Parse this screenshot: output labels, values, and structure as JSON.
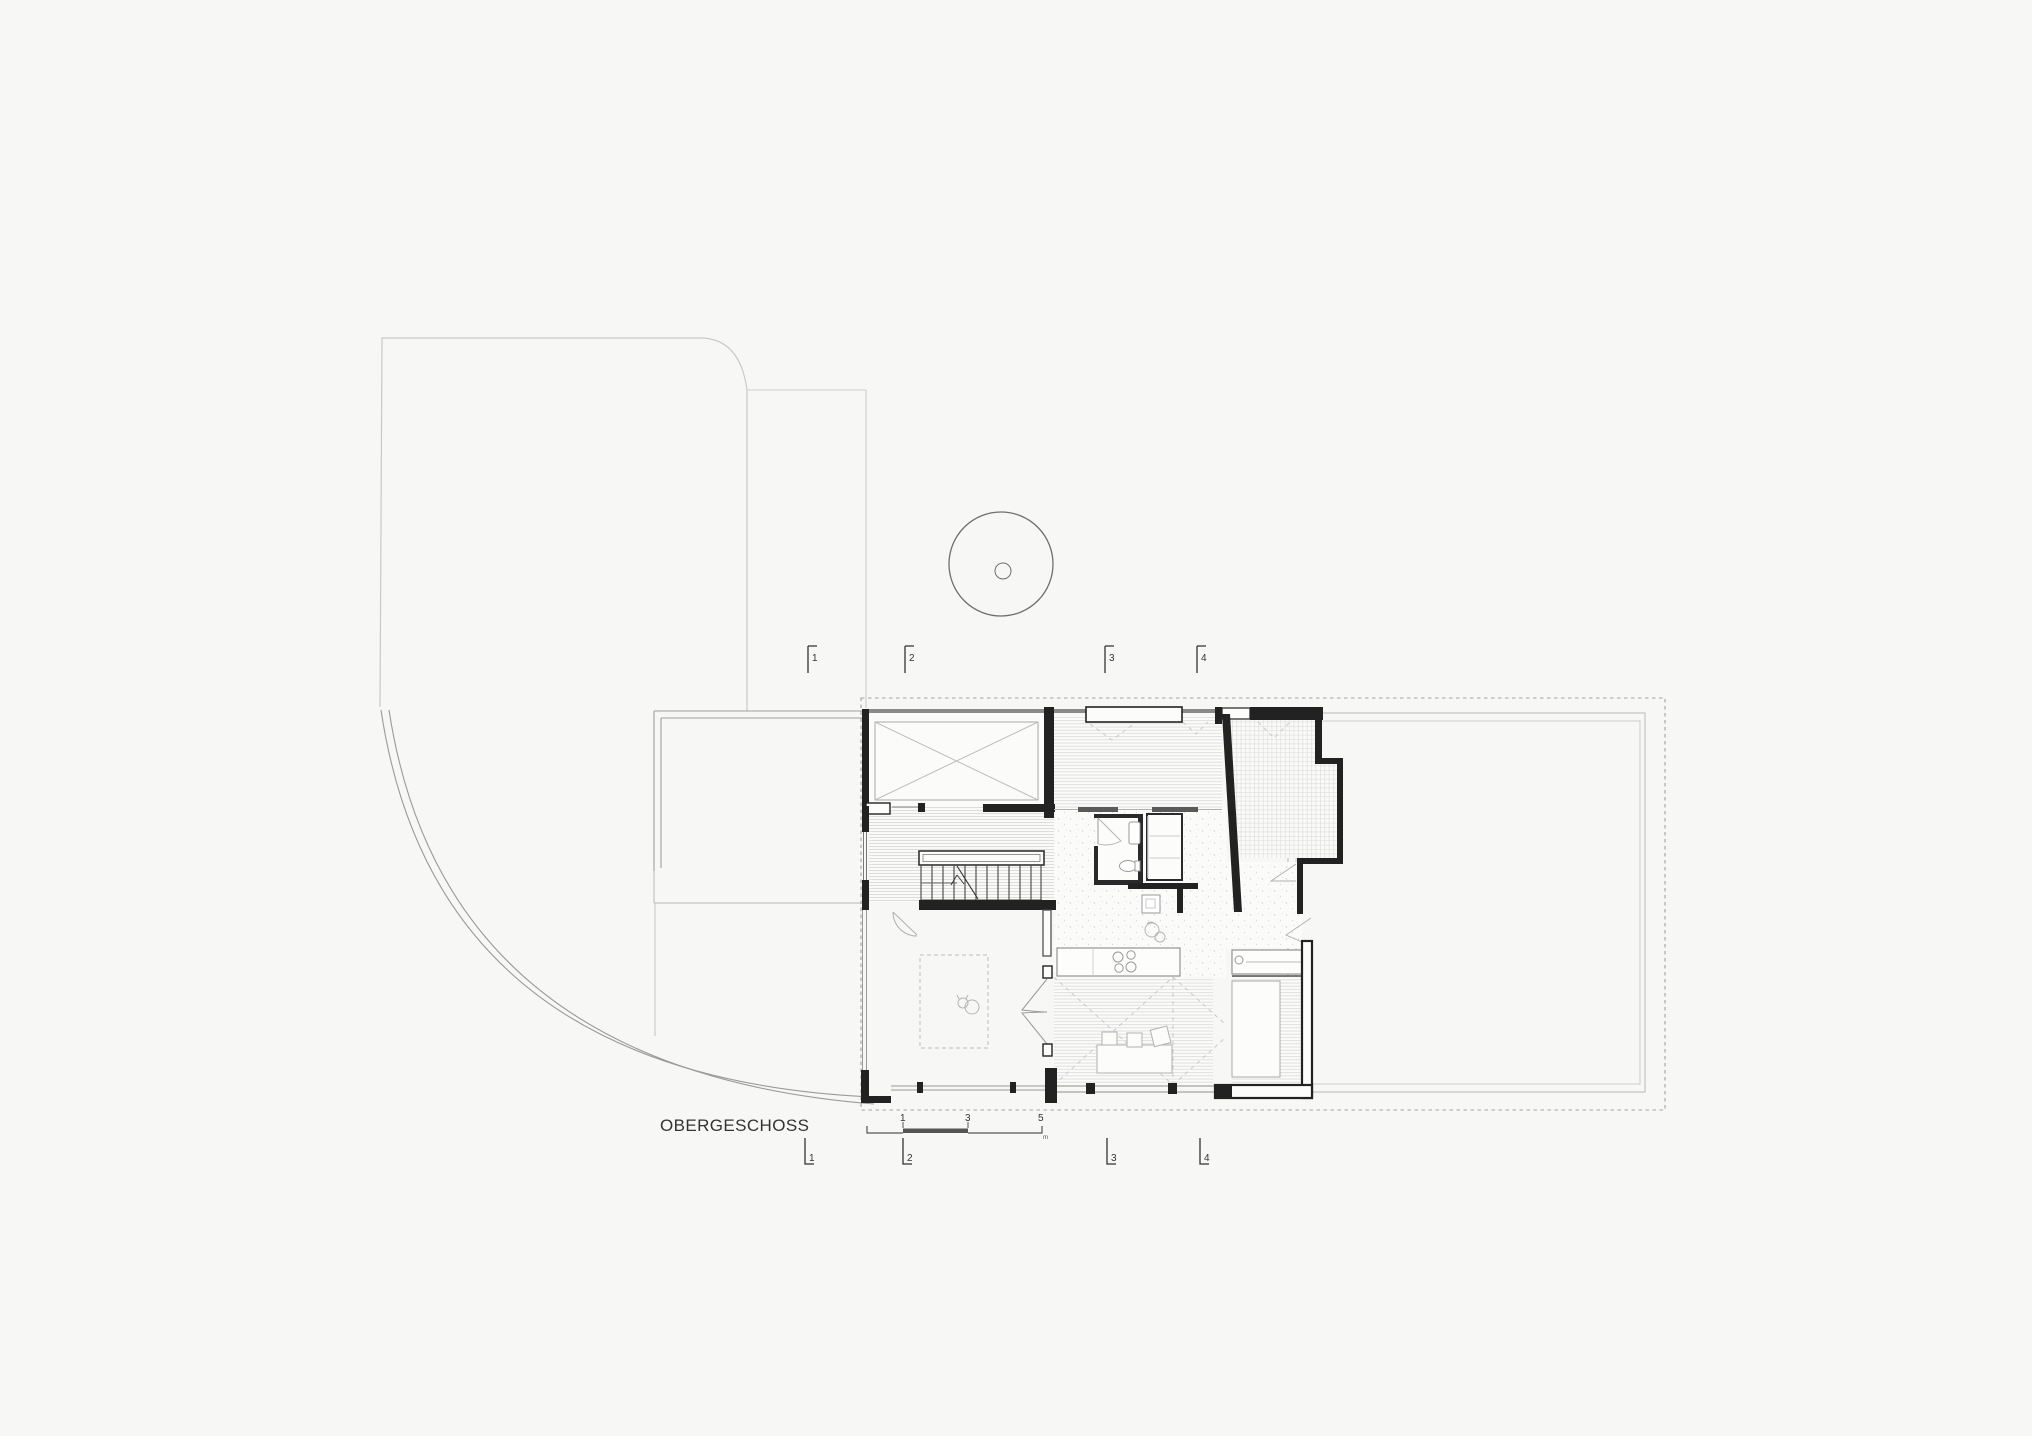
{
  "title": "OBERGESCHOSS",
  "section_markers": {
    "top": [
      {
        "label": "1"
      },
      {
        "label": "2"
      },
      {
        "label": "3"
      },
      {
        "label": "4"
      }
    ],
    "bottom": [
      {
        "label": "1"
      },
      {
        "label": "2"
      },
      {
        "label": "3"
      },
      {
        "label": "4"
      }
    ]
  },
  "scale_bar": {
    "ticks": [
      {
        "label": "1"
      },
      {
        "label": "3"
      },
      {
        "label": "5"
      }
    ],
    "unit": "m"
  },
  "colors": {
    "background": "#f7f7f5",
    "wall_black": "#222222",
    "wall_gray": "#8a8a8a",
    "line_light": "#c9c9c9",
    "line_medium": "#9a9a9a",
    "hatch": "#d9d9d9",
    "dash": "#a3a3a3",
    "text": "#333333"
  }
}
